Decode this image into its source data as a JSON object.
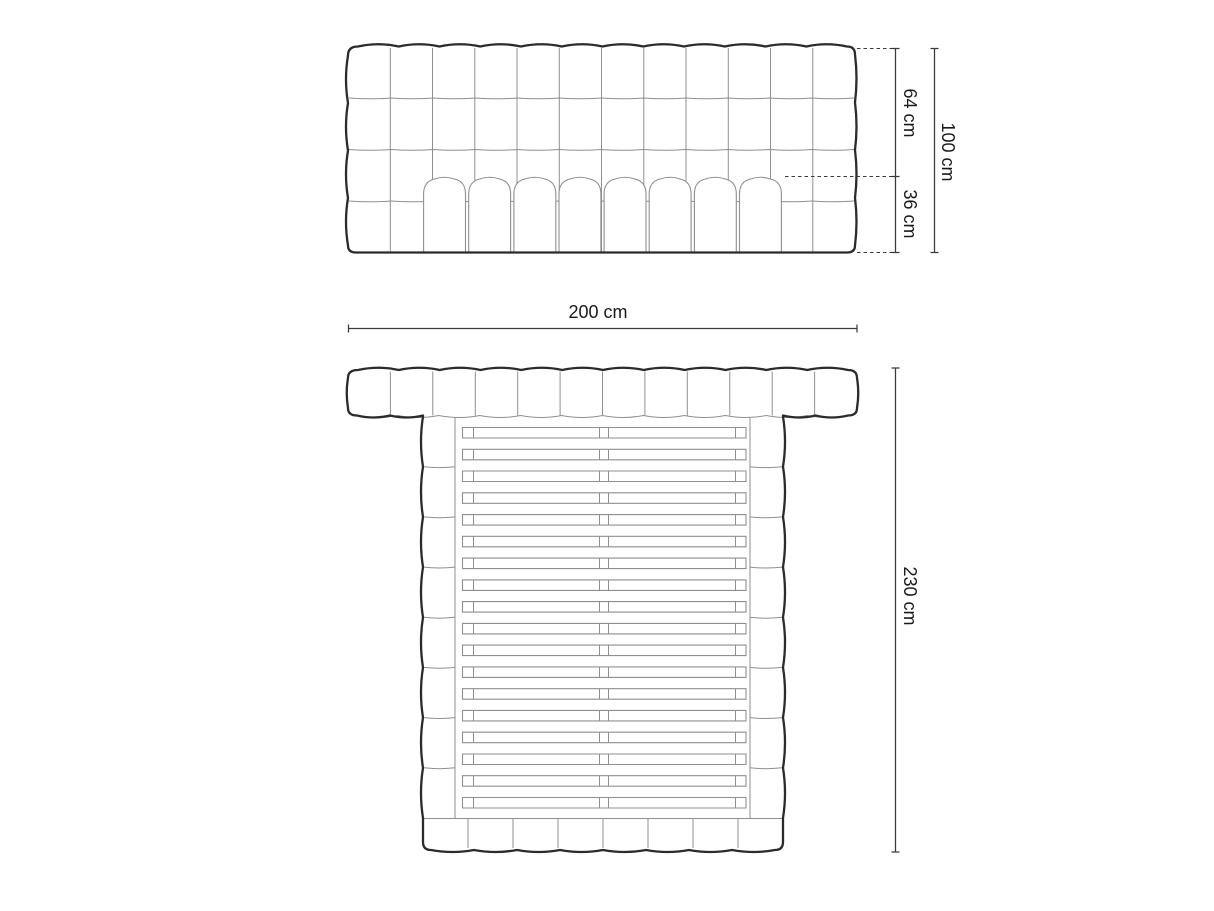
{
  "diagram": {
    "type": "furniture-dimension-drawing",
    "subject": "upholstered bed with tufted headboard and slatted base",
    "units": "cm",
    "dimensions_cm": {
      "headboard_total_height": 100,
      "headboard_upper_height": 64,
      "base_height": 36,
      "width": 200,
      "length": 230
    },
    "labels": {
      "front_upper": "64 cm",
      "front_lower": "36 cm",
      "front_total": "100 cm",
      "plan_width": "200 cm",
      "plan_length": "230 cm"
    },
    "views": {
      "front": {
        "name": "front elevation",
        "grid_columns": 12,
        "grid_rows": 4,
        "mattress_channels": 8
      },
      "plan": {
        "name": "top view",
        "headboard_segments": 12,
        "side_rail_segments_per_side": 8,
        "footer_segments": 8,
        "slats": 18,
        "slats_split_at_center": true
      }
    },
    "colors": {
      "outline": "#2b2b2b",
      "inner_line": "#8f8f8f",
      "dimension": "#3a3a3a",
      "background": "#ffffff"
    }
  }
}
